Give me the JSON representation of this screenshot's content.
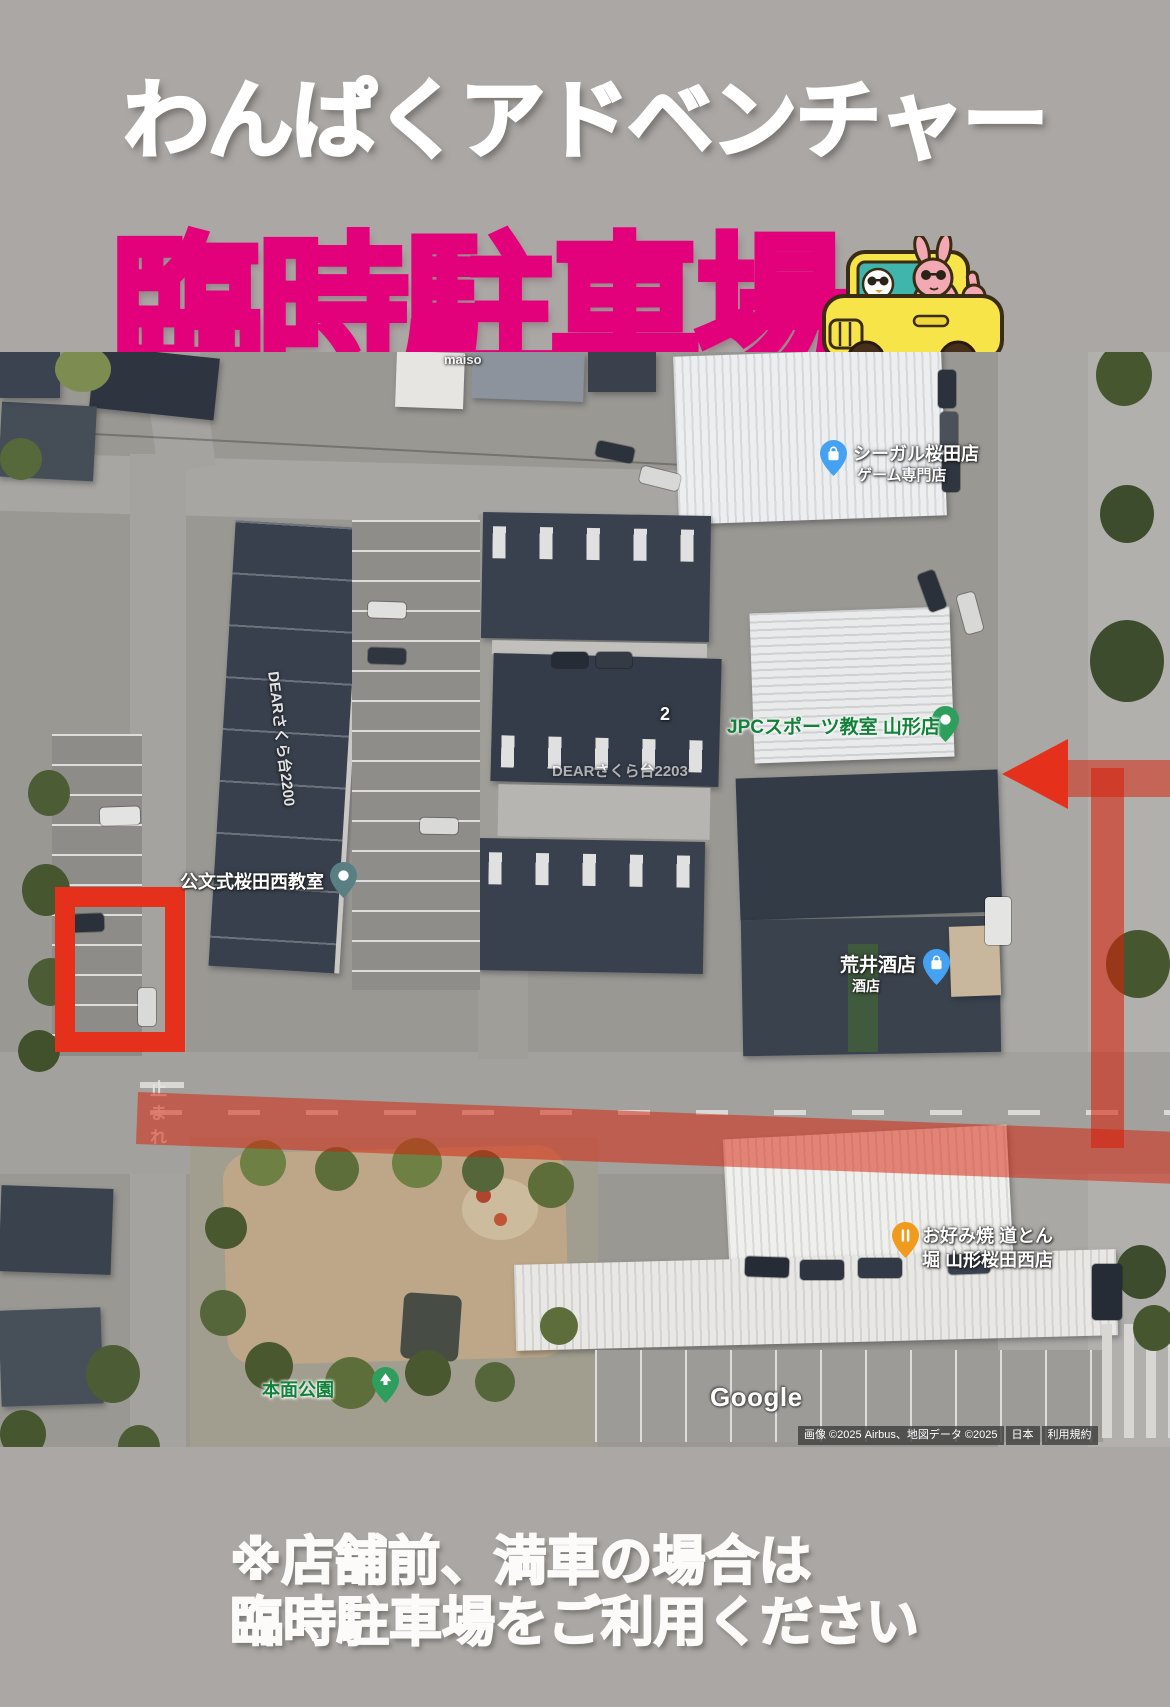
{
  "page": {
    "background": "#aaa7a4"
  },
  "header": {
    "title": "わんぱくアドベンチャー",
    "subtitle": "臨時駐車場",
    "colors": {
      "title": "#ffffff",
      "subtitle": "#e3017b"
    }
  },
  "car_sticker": {
    "car_color": "#f7e449",
    "window_color": "#3fb5ac",
    "character_color": "#f3a9b4"
  },
  "map": {
    "places": {
      "seagull": {
        "line1": "シーガル桜田店",
        "line2": "ゲーム専門店",
        "pin_color": "#45a2f3"
      },
      "jpc": {
        "label": "JPCスポーツ教室 山形店",
        "text_color": "#13813a",
        "pin_color": "#2e9e5c"
      },
      "kumon": {
        "label": "公文式桜田西教室",
        "pin_color": "#597f82"
      },
      "arai": {
        "line1": "荒井酒店",
        "line2": "酒店",
        "pin_color": "#45a2f3"
      },
      "okonomiyaki": {
        "line1": "お好み焼 道とん",
        "line2": "堀 山形桜田西店",
        "pin_color": "#f09a1e"
      },
      "park": {
        "label": "本面公園",
        "text_color": "#13813a",
        "pin_color": "#2e9e5c"
      },
      "dear_building": {
        "label": "DEARさくら台2200"
      },
      "dear_building2": {
        "label": "DEARさくら台2203"
      },
      "partial_top": {
        "label": "maiso"
      },
      "lot_number": {
        "label": "2"
      }
    },
    "road_marking": "止まれ",
    "google_logo": "Google",
    "attribution": {
      "imagery": "画像 ©2025 Airbus、地図データ ©2025",
      "region": "日本",
      "terms": "利用規約"
    },
    "annotation_color": "#e5311c"
  },
  "footer": {
    "line1": "※店舗前、満車の場合は",
    "line2": "臨時駐車場をご利用ください"
  }
}
